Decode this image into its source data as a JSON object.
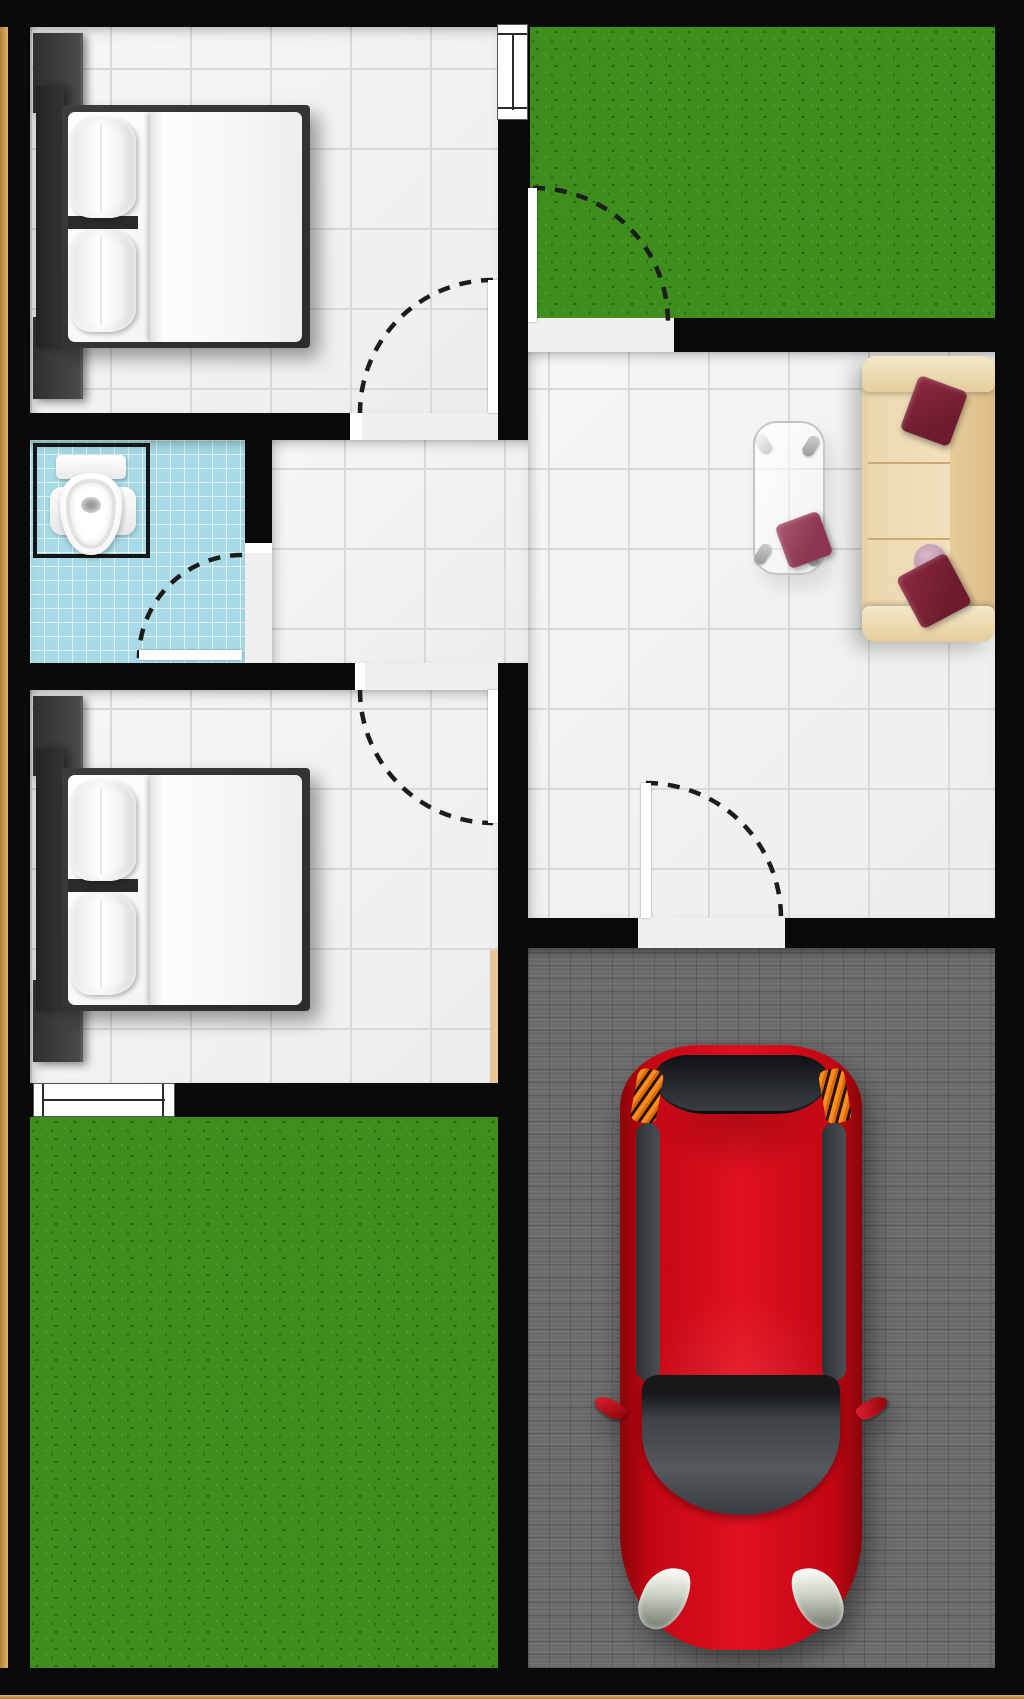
{
  "plan": {
    "type": "house-floor-plan-top-view",
    "canvas": {
      "width": 1024,
      "height": 1699
    },
    "colors": {
      "wall": "#0a0a0a",
      "trim": "#c99a4a",
      "tile": "#f2f2f1",
      "grout": "#d9d9d7",
      "tile_plain": "#f0f0ee",
      "bath_tile": "#a7dae6",
      "grass": "#3e8e1e",
      "paving": "#6c6c6c",
      "sofa_base": "#eed9b2",
      "sofa_dark": "#dfc08a",
      "sofa_seam": "#c9aa74",
      "maroon": "#7b2137",
      "maroon_light": "#9c4f63",
      "pink": "#c9a6b6",
      "bed_dark": "#39393b",
      "mattress": "#f4f4f4",
      "duvet": "#fbfbfb",
      "car_red": "#d00915",
      "car_red_dark": "#8c0309",
      "glass_dark": "#3a3d41",
      "taillight": "#ff8c1e",
      "headlight": "#eef0e6",
      "wood": "#e9c795",
      "arc": "#1c1c1c"
    },
    "rooms": [
      {
        "id": "bedroom-1",
        "floor": "white-tile"
      },
      {
        "id": "bathroom",
        "floor": "blue-tile"
      },
      {
        "id": "hallway",
        "floor": "white-tile"
      },
      {
        "id": "living-room",
        "floor": "white-tile"
      },
      {
        "id": "bedroom-2",
        "floor": "white-tile"
      },
      {
        "id": "front-yard",
        "floor": "grass"
      },
      {
        "id": "back-yard",
        "floor": "grass"
      },
      {
        "id": "garage",
        "floor": "gray-paving"
      }
    ],
    "furniture": [
      {
        "id": "double-bed-1",
        "room": "bedroom-1",
        "pillows": 2
      },
      {
        "id": "double-bed-2",
        "room": "bedroom-2",
        "pillows": 2
      },
      {
        "id": "toilet",
        "room": "bathroom"
      },
      {
        "id": "sofa",
        "room": "living-room",
        "seats": 3,
        "throw_pillows": 3
      },
      {
        "id": "coffee-table",
        "room": "living-room",
        "material": "glass",
        "throw_pillows": 1
      },
      {
        "id": "car",
        "room": "garage",
        "color_name": "red",
        "orientation": "front-facing-down"
      }
    ],
    "doors": [
      {
        "id": "door-bedroom-1",
        "swing": "into-bedroom-1"
      },
      {
        "id": "door-entry",
        "swing": "onto-front-yard"
      },
      {
        "id": "door-bathroom",
        "swing": "into-bathroom"
      },
      {
        "id": "door-bedroom-2",
        "swing": "into-bedroom-2"
      },
      {
        "id": "door-garage",
        "swing": "into-living-room"
      }
    ],
    "windows": [
      {
        "id": "window-bedroom-1",
        "between": "bedroom-1|front-yard"
      },
      {
        "id": "window-bedroom-2",
        "between": "bedroom-2|back-yard"
      }
    ]
  }
}
